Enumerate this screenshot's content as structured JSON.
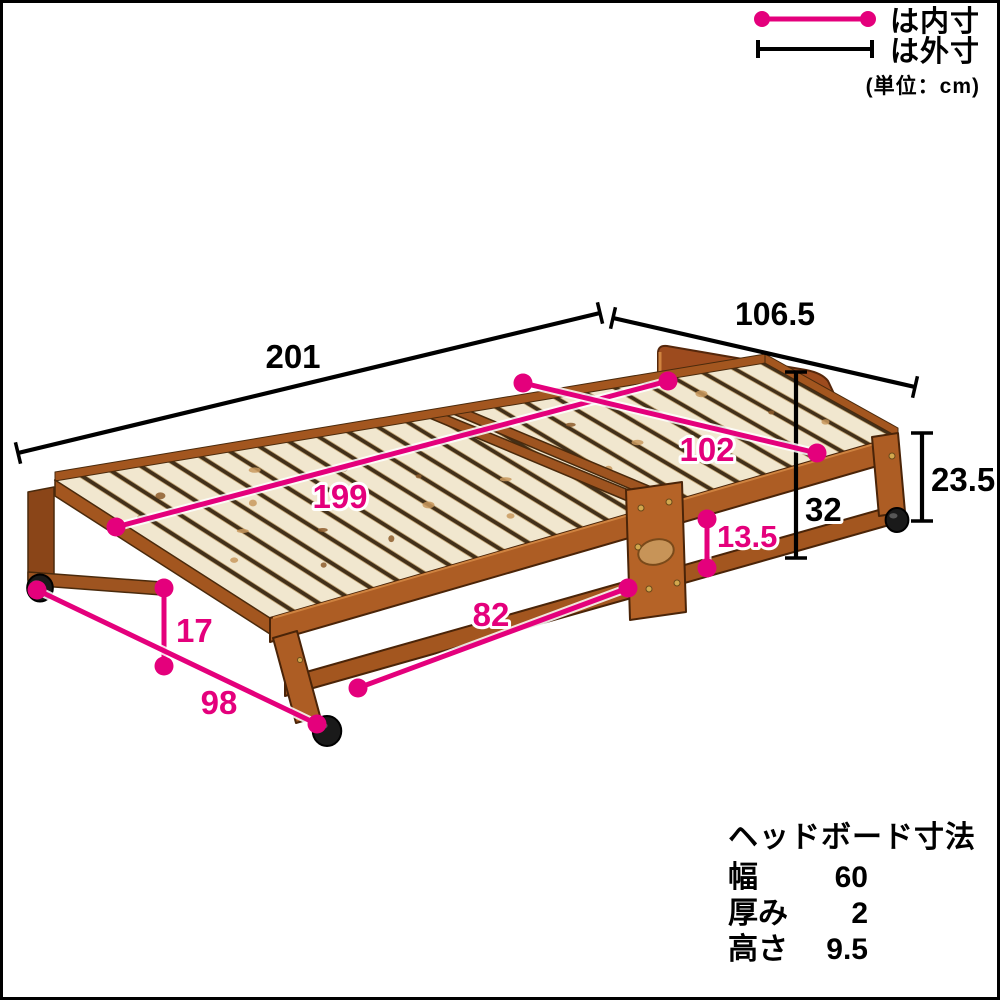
{
  "page": {
    "background": "#ffffff",
    "border_color": "#000000"
  },
  "legend": {
    "inner_label": "は内寸",
    "outer_label": "は外寸",
    "unit_note": "(単位：cm)"
  },
  "dimensions": [
    {
      "id": "outer-length",
      "value": "201",
      "type": "outer"
    },
    {
      "id": "outer-width",
      "value": "106.5",
      "type": "outer"
    },
    {
      "id": "headboard-top-height",
      "value": "32",
      "type": "outer"
    },
    {
      "id": "end-frame-height",
      "value": "23.5",
      "type": "outer"
    },
    {
      "id": "inner-length",
      "value": "199",
      "type": "inner"
    },
    {
      "id": "inner-width",
      "value": "102",
      "type": "inner"
    },
    {
      "id": "side-rail-gap",
      "value": "13.5",
      "type": "inner"
    },
    {
      "id": "under-bed-length",
      "value": "82",
      "type": "inner"
    },
    {
      "id": "under-bed-height",
      "value": "17",
      "type": "inner"
    },
    {
      "id": "caster-span",
      "value": "98",
      "type": "inner"
    }
  ],
  "headboard_spec": {
    "title": "ヘッドボード寸法",
    "rows": [
      {
        "label": "幅",
        "value": "60"
      },
      {
        "label": "厚み",
        "value": "2"
      },
      {
        "label": "高さ",
        "value": "9.5"
      }
    ]
  },
  "colors": {
    "inner_dimension": "#e4007c",
    "outer_dimension": "#000000",
    "frame_wood": "#ad5d24",
    "slat_wood": "#f1e7cf",
    "headboard_wood": "#9d4b1e",
    "caster": "#1a1a1a"
  }
}
